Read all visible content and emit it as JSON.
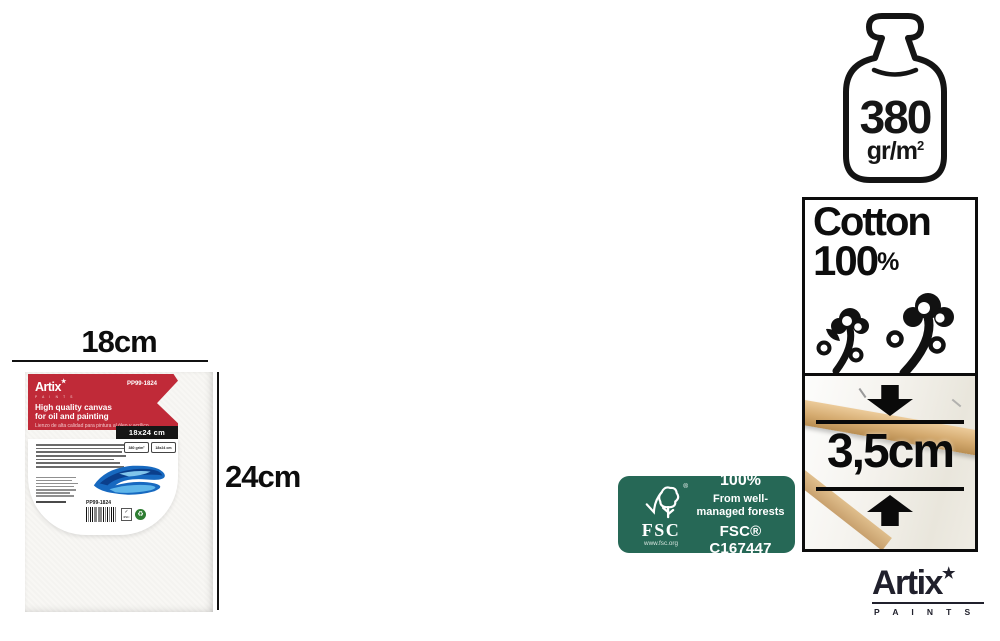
{
  "canvas_section": {
    "width_label": "18cm",
    "height_label": "24cm",
    "label": {
      "brand": "Artix",
      "brand_star": "★",
      "brand_sub": "P A I N T S",
      "sku": "PP99-1824",
      "title_line1": "High quality canvas",
      "title_line2": "for oil and painting",
      "subtitle_line1": "Lienzo de alta calidad para pintura al óleo y acrílico",
      "subtitle_line2": "Toile de haute qualité pour peinture à l'huile et acrylique",
      "size_bar": "18x24 cm",
      "mini_badge_weight": "380 gr/m²",
      "mini_badge_size": "18x24 cm",
      "barcode_sku": "PP99-1824",
      "mini_fsc_check": "✓",
      "mini_fsc": "FSC",
      "recycle_symbol": "♻"
    }
  },
  "badges": {
    "weight": {
      "value": "380",
      "unit_base": "gr/m",
      "unit_exp": "2"
    },
    "cotton": {
      "word": "Cotton",
      "number": "100",
      "percent": "%"
    },
    "depth": {
      "value": "3,5cm"
    }
  },
  "fsc": {
    "acronym": "FSC",
    "registered": "®",
    "url": "www.fsc.org",
    "percent": "100%",
    "claim_line1": "From well-",
    "claim_line2": "managed forests",
    "license": "FSC® C167447"
  },
  "footer_logo": {
    "brand": "Artix",
    "star": "★",
    "sub": "P A I N T S"
  },
  "colors": {
    "label_red": "#c02a38",
    "fsc_green": "#266856",
    "logo_dark": "#20202c",
    "recycle_green": "#2e7d32"
  }
}
